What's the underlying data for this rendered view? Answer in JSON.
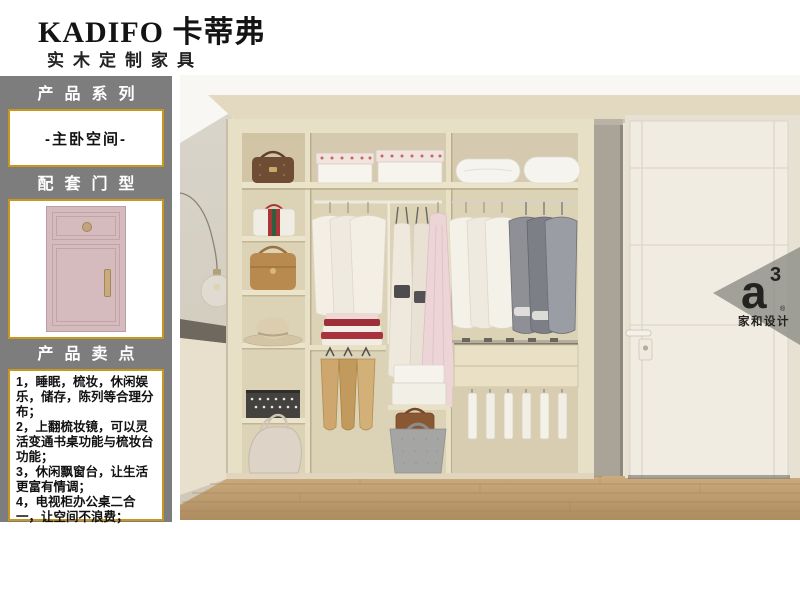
{
  "brand": {
    "logo": "KADIFO 卡蒂弗",
    "tagline": "实木定制家具"
  },
  "sidebar": {
    "series": {
      "title": "产品系列",
      "value": "-主卧空间-"
    },
    "door": {
      "title": "配套门型"
    },
    "points": {
      "title": "产品卖点",
      "items": [
        "1，睡眠，梳妆，休闲娱乐，储存，陈列等合理分布；",
        "2，上翻梳妆镜，可以灵活变通书桌功能与梳妆台功能；",
        "3，休闲飘窗台，让生活更富有情调；",
        "4，电视柜办公桌二合一，让空间不浪费；"
      ]
    }
  },
  "badge": {
    "logo_main": "a",
    "logo_sup": "3",
    "reg": "®",
    "name": "家和设计"
  },
  "colors": {
    "accent_gold": "#c9971d",
    "sidebar_gray": "#7d7d7d",
    "door_pink": "#d5babe",
    "wardrobe_cream": "#e8dfc7",
    "floor_wood": "#bfa074",
    "badge_gray": "#8b8a84"
  }
}
